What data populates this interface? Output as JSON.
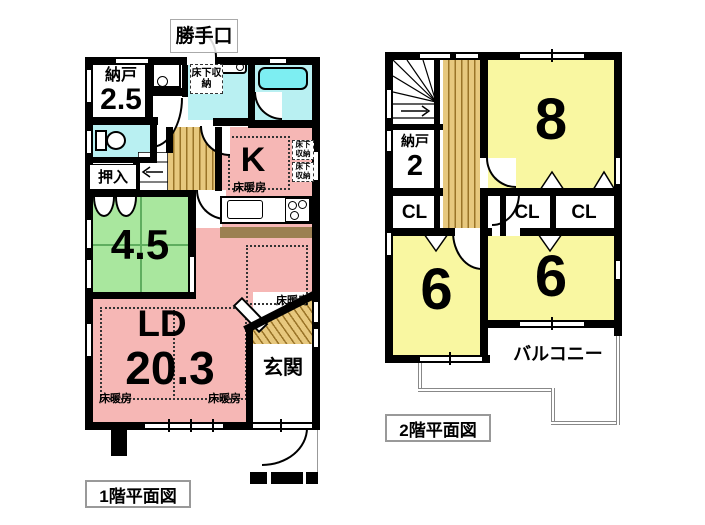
{
  "colors": {
    "wall": "#000000",
    "room_pink": "#f6b7b5",
    "room_cyan": "#b9f0f2",
    "bathtub_cyan": "#7deef2",
    "room_green": "#a9e79e",
    "room_yellow": "#f9f7a1",
    "wood": "#e7c87e",
    "counter_brown": "#9c8052",
    "balcony_line": "#888888"
  },
  "floor1": {
    "caption": "1階平面図",
    "rooms": {
      "nando_label": "納戸",
      "nando_size": "2.5",
      "oshiire": "押入",
      "washitsu_size": "4.5",
      "kitchen": "K",
      "ld_label": "LD",
      "ld_size": "20.3",
      "genkan": "玄関",
      "katteguchi": "勝手口"
    },
    "labels": {
      "underfloor_storage": "床下収納",
      "floor_heating": "床暖房"
    }
  },
  "floor2": {
    "caption": "2階平面図",
    "rooms": {
      "nando_label": "納戸",
      "nando_size": "2",
      "room8_size": "8",
      "room6a_size": "6",
      "room6b_size": "6",
      "closet": "CL",
      "balcony": "バルコニー"
    }
  }
}
